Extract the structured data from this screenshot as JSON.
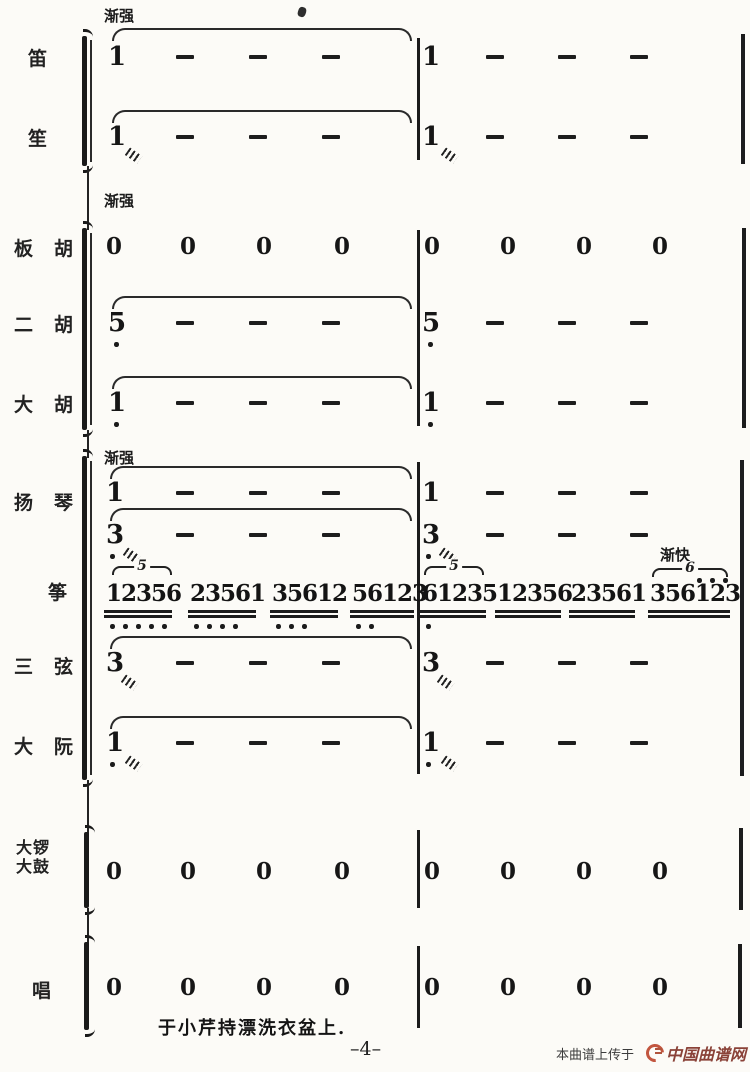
{
  "page": {
    "caption": "于小芹持漂洗衣盆上.",
    "page_number": "–4–"
  },
  "watermark": {
    "prefix": "本曲谱上传于",
    "site": "中国曲谱网",
    "logo_color": "#c2563f",
    "site_color": "#8a4238"
  },
  "dynamics": {
    "crescendo": "渐强",
    "accelerando": "渐快"
  },
  "instruments": {
    "di": "笛",
    "sheng": "笙",
    "banhu": "板　胡",
    "erhu": "二　胡",
    "dahu": "大　胡",
    "yangqin": "扬　琴",
    "zheng": "筝",
    "sanxian": "三　弦",
    "daruan": "大　阮",
    "daluo": "大锣",
    "dagu": "大鼓",
    "chang": "唱"
  },
  "notes": {
    "di": {
      "m1": "1",
      "m2": "1",
      "pattern": "1 — — — | 1 — — —"
    },
    "sheng": {
      "m1": "1",
      "m2": "1",
      "pattern": "1/// — — — | 1/// — — —"
    },
    "banhu": {
      "pattern": "0 0 0 0 | 0 0 0 0"
    },
    "erhu": {
      "m1": "5",
      "m2": "5",
      "octave": "low",
      "pattern": "5̣ — — — | 5̣ — — —"
    },
    "dahu": {
      "m1": "1",
      "m2": "1",
      "octave": "low",
      "pattern": "1̣ — — — | 1̣ — — —"
    },
    "yangqin_upper": {
      "m1": "1",
      "m2": "1",
      "pattern": "1 — — — | 1 — — —"
    },
    "yangqin_lower": {
      "m1": "3",
      "m2": "3",
      "pattern": "3̣/// — — — | 3̣/// — — —"
    },
    "sanxian": {
      "m1": "3",
      "m2": "3",
      "pattern": "3/// — — — | 3/// — — —"
    },
    "daruan": {
      "m1": "1",
      "m2": "1",
      "octave": "low",
      "pattern": "1̣/// — — — | 1̣/// — — —"
    },
    "luogu": {
      "pattern": "0 0 0 0 | 0 0 0 0"
    },
    "chang": {
      "pattern": "0 0 0 0 | 0 0 0 0"
    }
  },
  "zeros": [
    "0",
    "0",
    "0",
    "0",
    "0",
    "0",
    "0",
    "0"
  ],
  "zheng": {
    "tuplet5": "5",
    "tuplet6": "6",
    "groups": [
      {
        "digits": "12356",
        "low_dots": 5
      },
      {
        "digits": "23561",
        "low_dots": 4
      },
      {
        "digits": "35612",
        "low_dots": 3
      },
      {
        "digits": "56123",
        "low_dots": 2
      },
      {
        "digits": "61235",
        "low_dots": 1
      },
      {
        "digits": "12356",
        "low_dots": 0
      },
      {
        "digits": "23561",
        "low_dots": 0
      },
      {
        "digits": "356123",
        "low_dots": 0,
        "high_dots": 3
      }
    ]
  }
}
